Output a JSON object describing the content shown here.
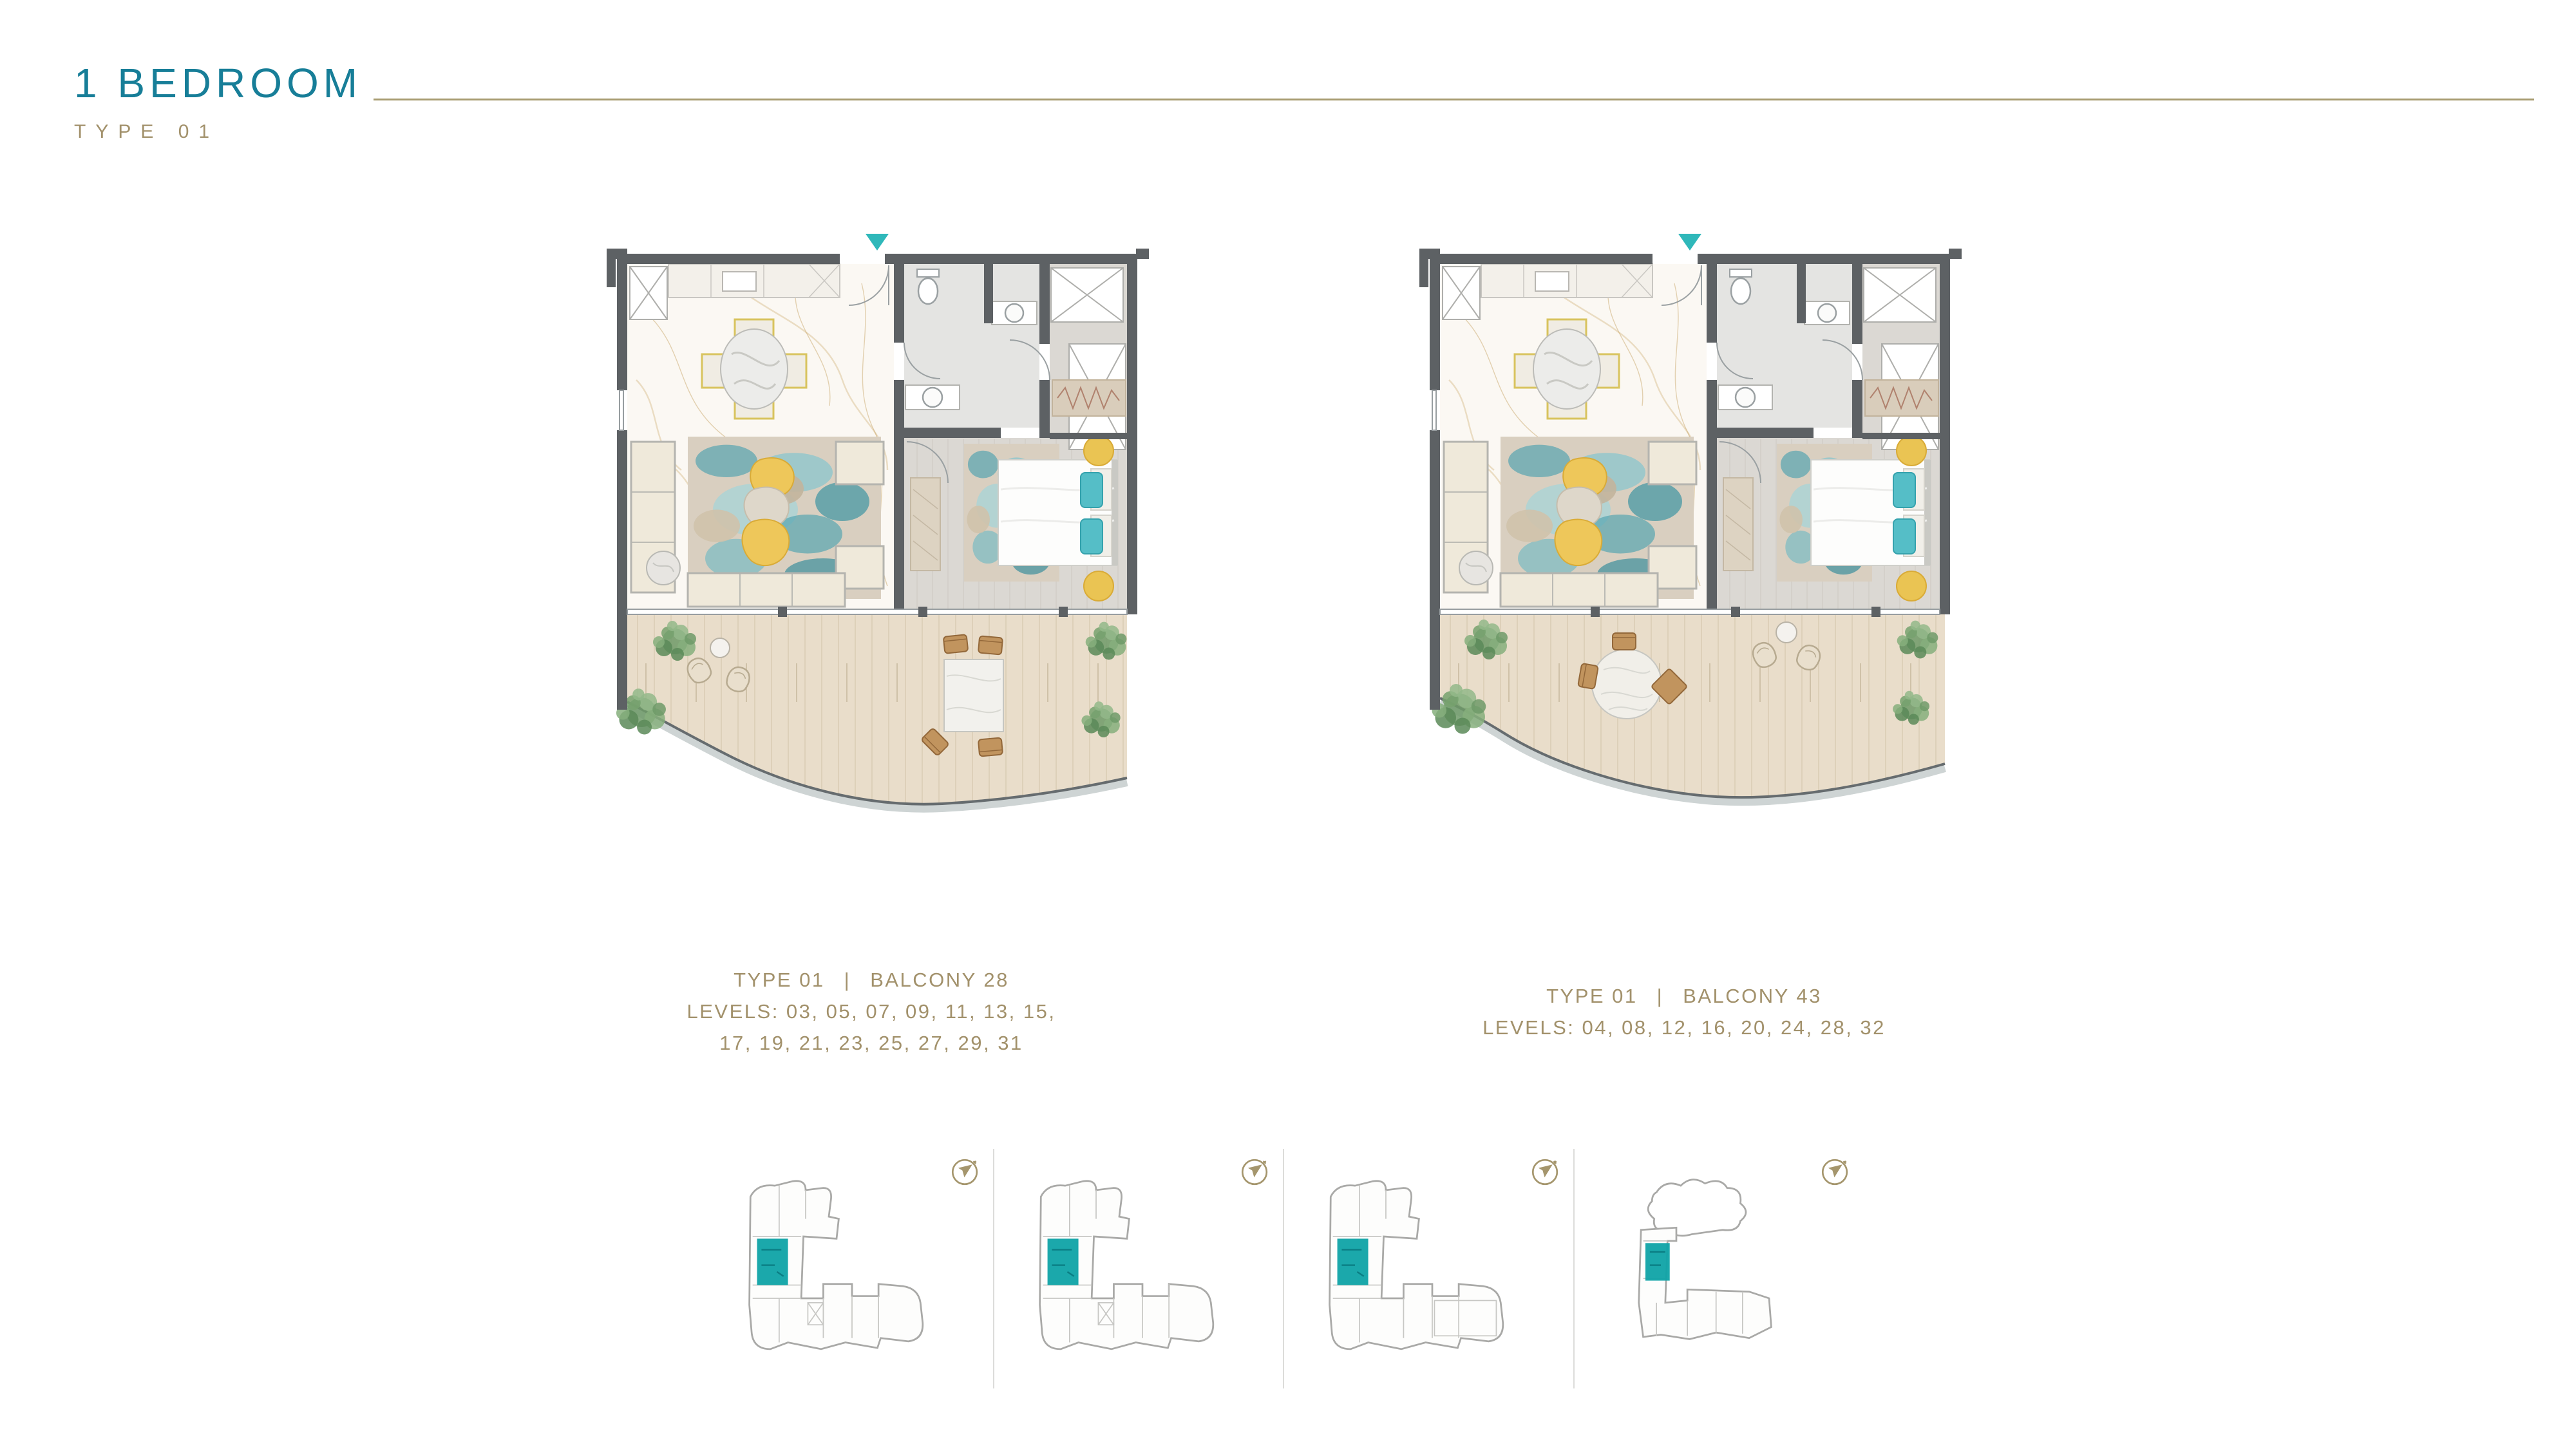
{
  "page": {
    "title": "1 BEDROOM",
    "subtitle": "TYPE 01"
  },
  "plans": [
    {
      "caption": {
        "type": "TYPE 01",
        "divider": "|",
        "balcony": "BALCONY 28",
        "levels": [
          "LEVELS: 03, 05, 07, 09, 11, 13, 15,",
          "17, 19, 21, 23, 25, 27, 29, 31"
        ]
      }
    },
    {
      "caption": {
        "type": "TYPE 01",
        "divider": "|",
        "balcony": "BALCONY 43",
        "levels": [
          "LEVELS: 04, 08, 12, 16, 20, 24, 28, 32"
        ]
      }
    }
  ],
  "key_plans": {
    "count": 4,
    "highlight_color": "#0fa3a7",
    "compass_icon": "north-arrow"
  },
  "icons": {
    "entry_marker": "triangle-down"
  },
  "colors": {
    "title_teal": "#177e98",
    "gold_text": "#a2916b",
    "gold_rule": "#a79b6f",
    "accent_teal": "#2fb8ba",
    "wall_gray": "#5d6164",
    "keyplan_teal": "#0fa3a7"
  }
}
